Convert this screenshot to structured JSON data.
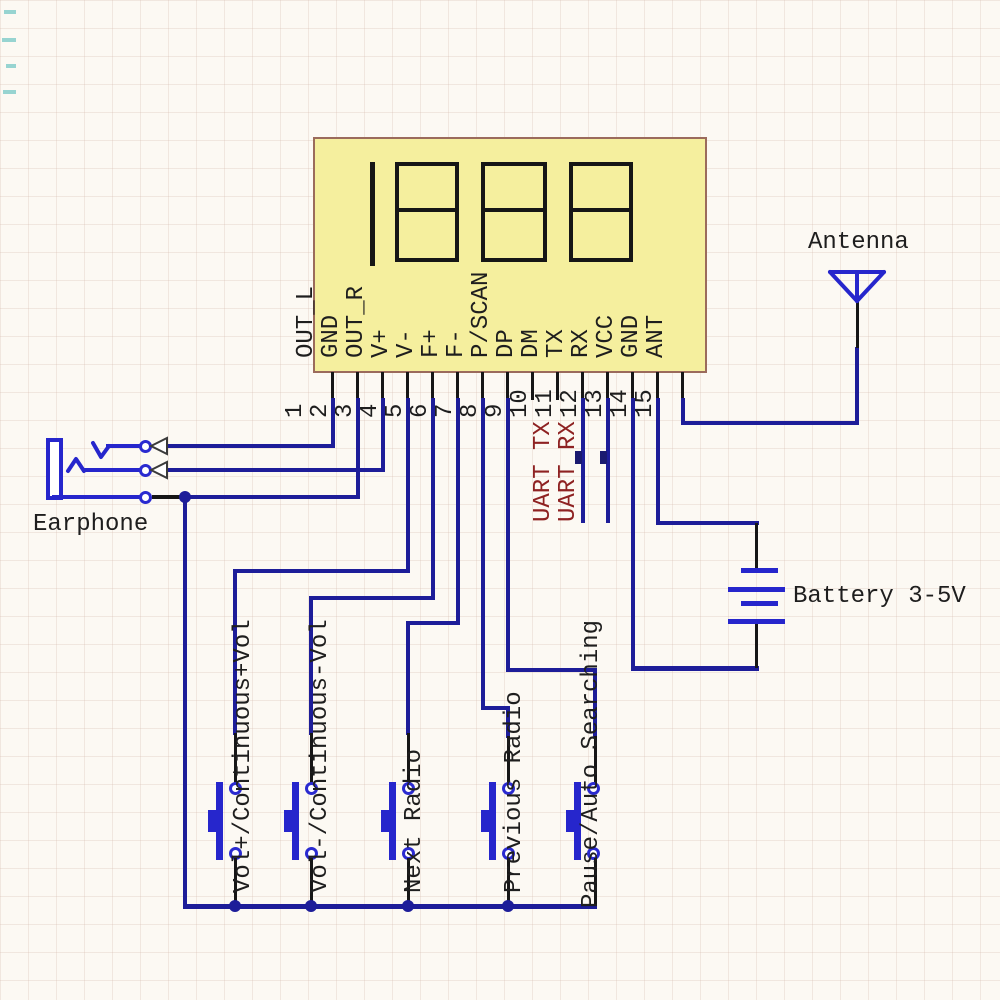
{
  "schematic": {
    "module": {
      "display_value": "1888",
      "pins": [
        {
          "n": "1",
          "label": "OUT_L"
        },
        {
          "n": "2",
          "label": "GND"
        },
        {
          "n": "3",
          "label": "OUT_R"
        },
        {
          "n": "4",
          "label": "V+"
        },
        {
          "n": "5",
          "label": "V-"
        },
        {
          "n": "6",
          "label": "F+"
        },
        {
          "n": "7",
          "label": "F-"
        },
        {
          "n": "8",
          "label": "P/SCAN"
        },
        {
          "n": "9",
          "label": "DP"
        },
        {
          "n": "10",
          "label": "DM"
        },
        {
          "n": "11",
          "label": "TX"
        },
        {
          "n": "12",
          "label": "RX"
        },
        {
          "n": "13",
          "label": "VCC"
        },
        {
          "n": "14",
          "label": "GND"
        },
        {
          "n": "15",
          "label": "ANT"
        }
      ]
    },
    "components": {
      "earphone": "Earphone",
      "antenna": "Antenna",
      "battery": "Battery 3-5V"
    },
    "annotations": {
      "uart_tx": "UART TX",
      "uart_rx": "UART RX"
    },
    "buttons": [
      {
        "label": "Vol+/Continuous+Vol"
      },
      {
        "label": "Vol-/Continuous-Vol"
      },
      {
        "label": "Next Radio"
      },
      {
        "label": "Previous Radio"
      },
      {
        "label": "Pause/Auto Searching"
      }
    ],
    "colors": {
      "wire": "#1d1d99",
      "accent_blue": "#2626cc",
      "module_fill": "#f5ef9e",
      "module_border": "#9b6b5c",
      "uart_text": "#8e2222",
      "black": "#161616"
    }
  }
}
